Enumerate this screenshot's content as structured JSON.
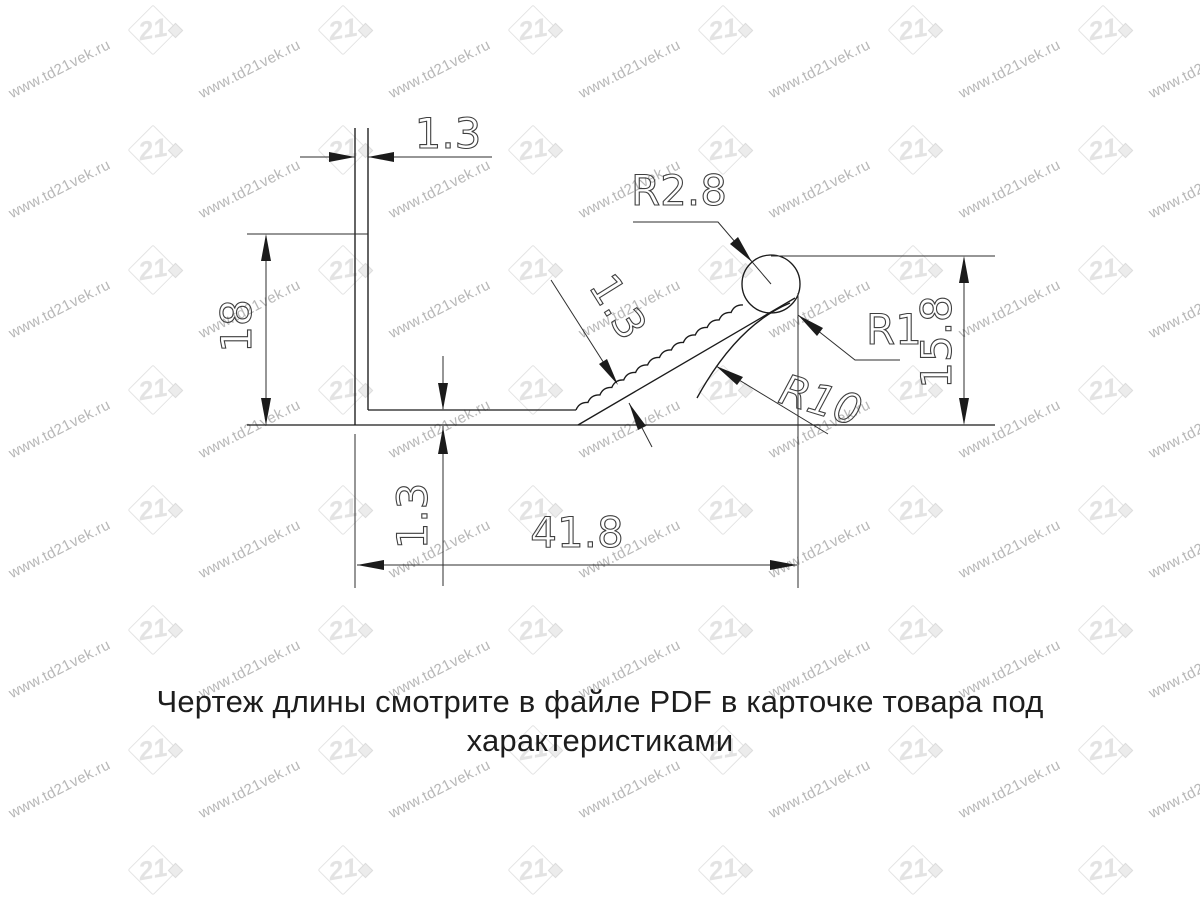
{
  "watermark": {
    "text": "www.td21vek.ru",
    "logo_text": "21",
    "text_color": "#b7b7b7",
    "logo_color": "#e3e3e3",
    "grid": {
      "cols": 7,
      "col_step": 190,
      "rows": 8,
      "row_step": 120,
      "logo_offset_x": 128,
      "logo_offset_y": 5,
      "text_offset_x": 10,
      "text_offset_y": 86,
      "text_rotation_deg": -27
    }
  },
  "drawing": {
    "line_color": "#1b1b1b",
    "dim_color": "#2e2e2e",
    "text_color": "#3f3f3f",
    "labels": {
      "top_thickness": "1.3",
      "wall_height": "18",
      "arm_thickness": "1.3",
      "bottom_thickness": "1.3",
      "total_width": "41.8",
      "right_height": "15.8",
      "bulb_radius": "R2.8",
      "underside_radius": "R10",
      "joint_radius": "R1"
    }
  },
  "caption": {
    "text": "Чертеж длины смотрите в файле PDF в карточке товара под характеристиками"
  }
}
